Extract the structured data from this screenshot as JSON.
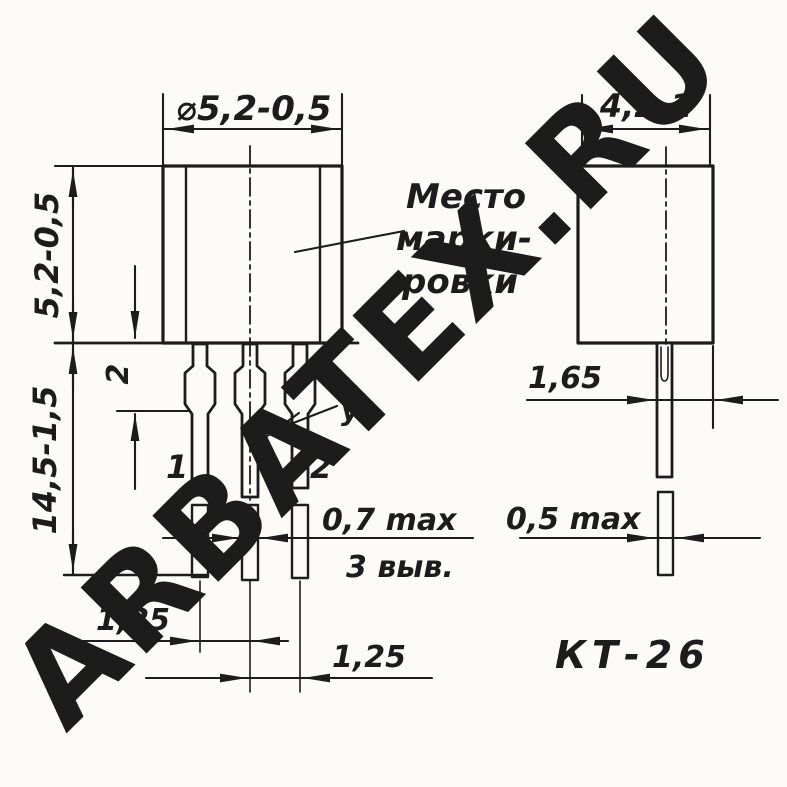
{
  "colors": {
    "ink": "#1c1c1c",
    "background": "#fcfbf8",
    "watermark": "rgba(228,88,88,0.5)"
  },
  "watermark": {
    "text": "ARBATEX.RU"
  },
  "package_label": "КТ-26",
  "front_view": {
    "dim_diameter": "⌀5,2-0,5",
    "dim_body_height": "5,2-0,5",
    "dim_total_length": "14,5-1,5",
    "dim_collar_length": "2",
    "marking_note": {
      "line1": "Место",
      "line2": "марки-",
      "line3": "ровки"
    },
    "electrode_label": "уэ",
    "pin_left": "1",
    "pin_right": "2",
    "dim_flat_width": "0,7 max",
    "leads_count_note": "3 выв.",
    "dim_pitch_left": "1,25",
    "dim_pitch_right": "1,25"
  },
  "side_view": {
    "dim_depth": "4,2-1",
    "dim_lead_offset": "1,65",
    "dim_flat_thickness": "0,5 max"
  }
}
